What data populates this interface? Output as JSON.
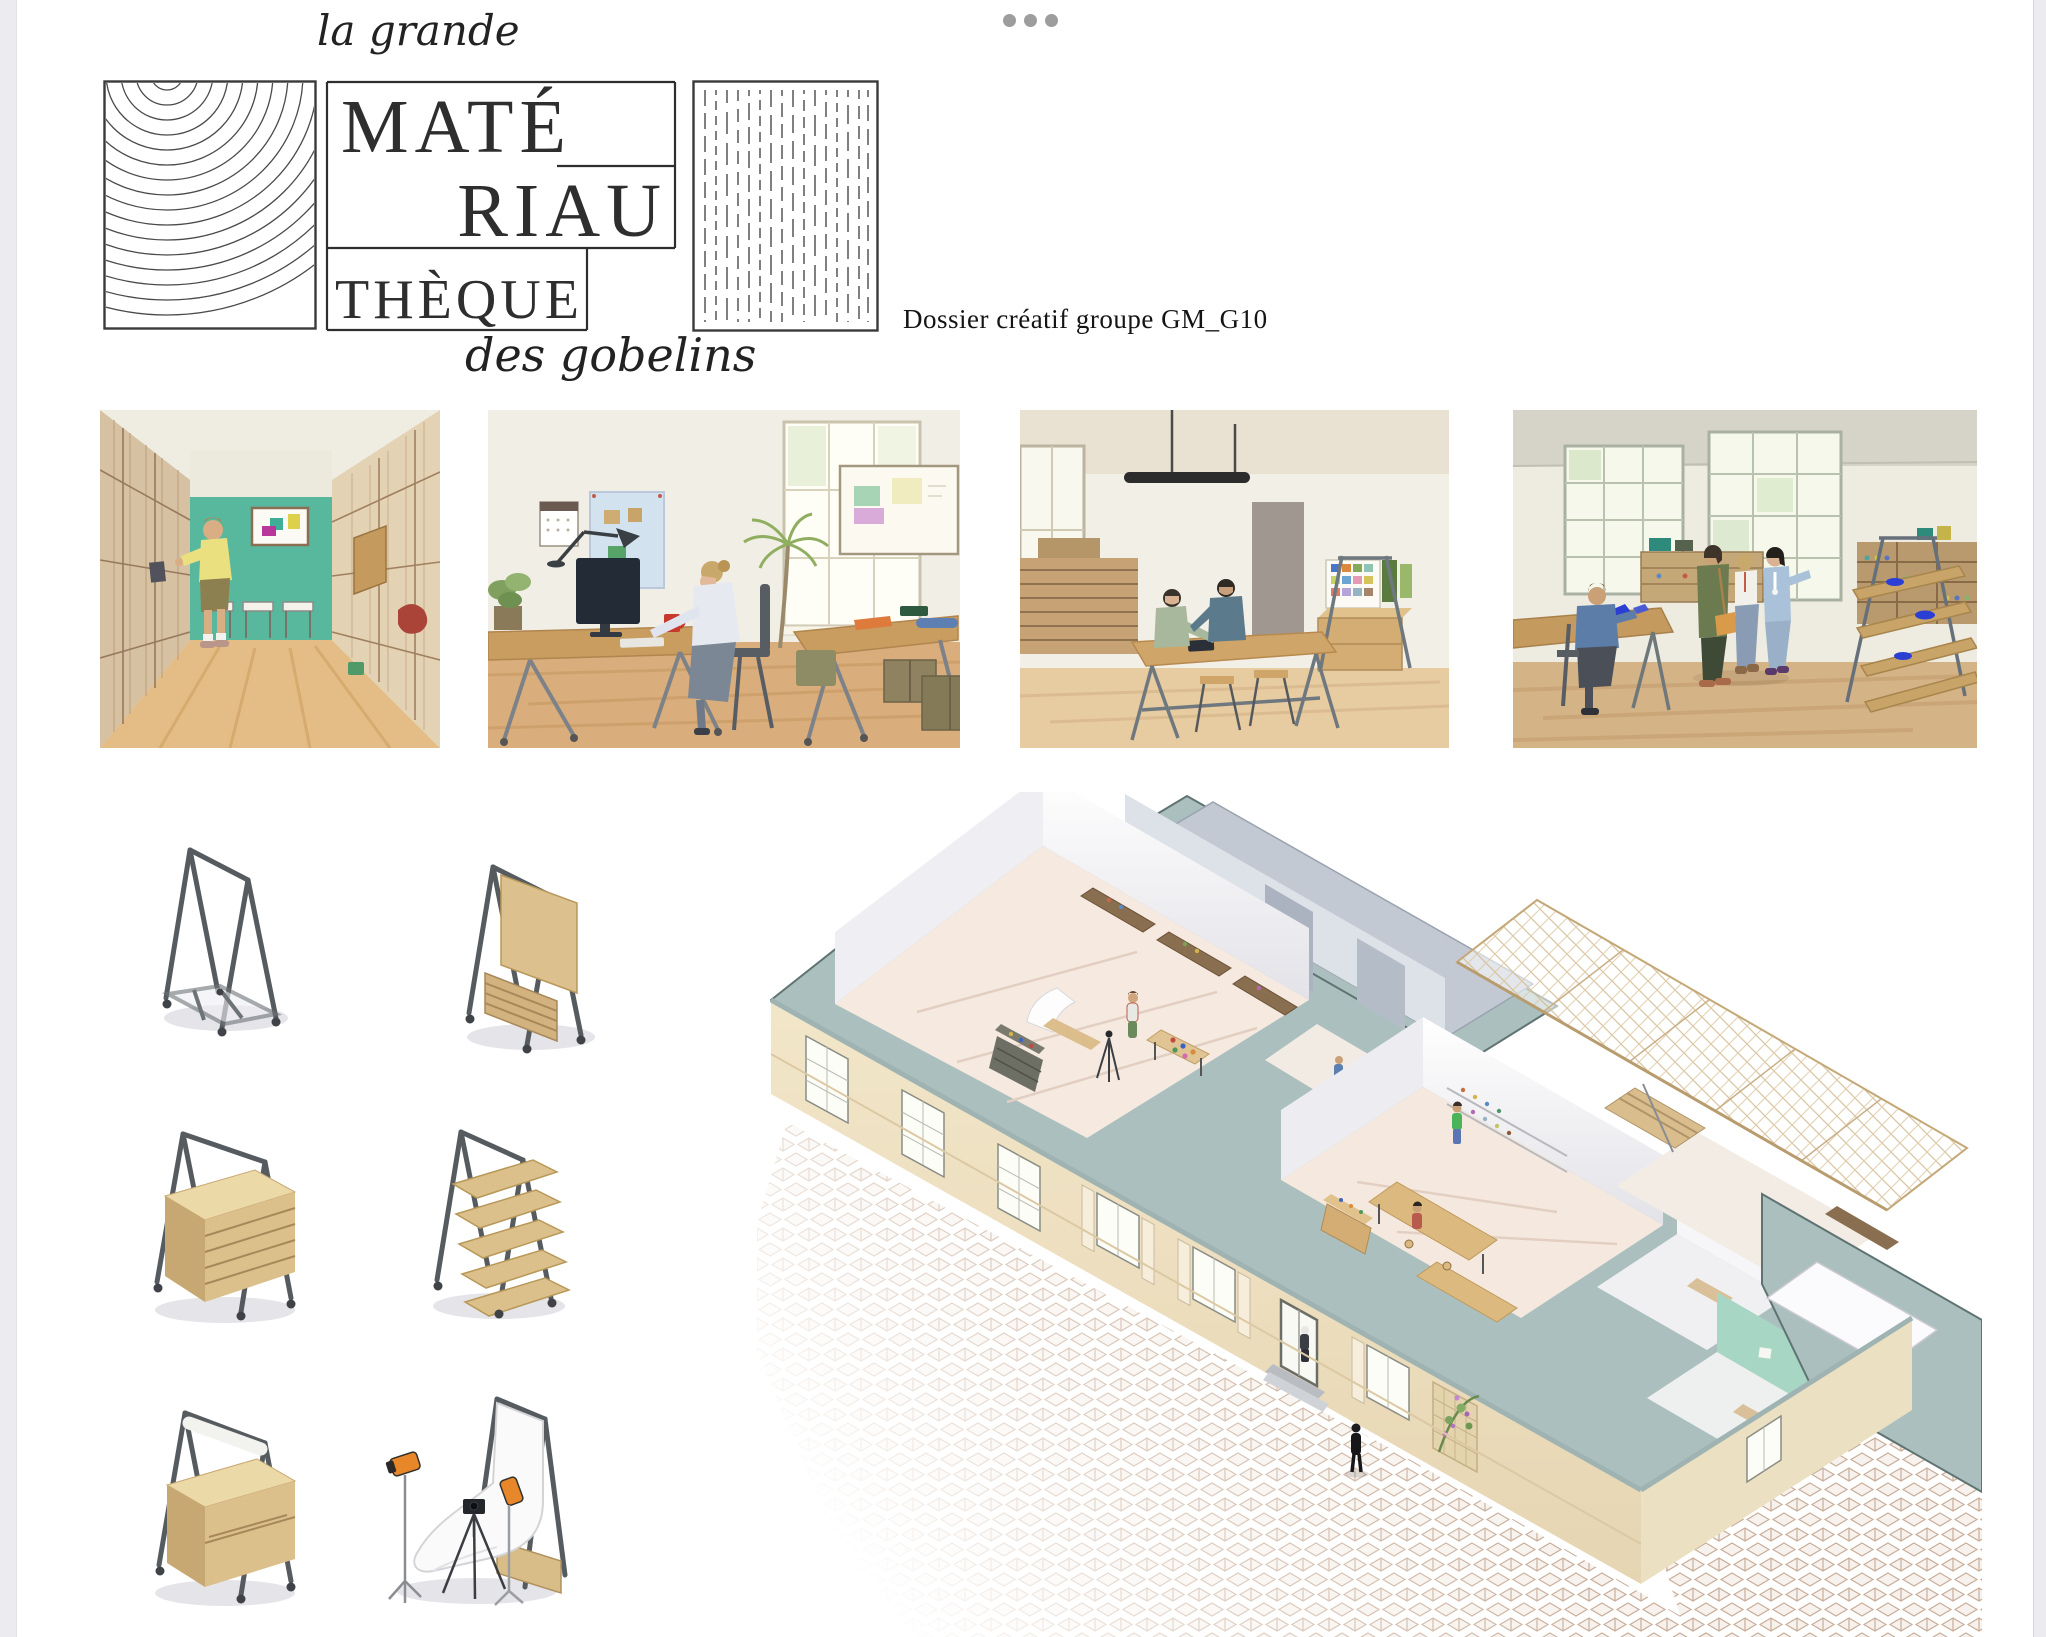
{
  "brand": {
    "pretitle": "la grande",
    "wordmark": [
      "MATÉ",
      "RIAU",
      "THÈQUE"
    ],
    "subtitle": "des gobelins",
    "caption": "Dossier créatif groupe GM_G10"
  },
  "icons": {
    "overflow_menu": "•••"
  },
  "palette": {
    "accent_teal": "#58b89d",
    "wall_top_sage": "#abc0be",
    "facade_cream": "#f0e3c6",
    "wood_light": "#dcc08e",
    "steel_grey": "#565b60",
    "floor_wood": "#e3bd85",
    "strobe_orange": "#e8872a",
    "sample_blue": "#2b3fd4",
    "ink": "#2e2e2e",
    "page_bg": "#ffffff",
    "app_bg": "#ececf0"
  }
}
